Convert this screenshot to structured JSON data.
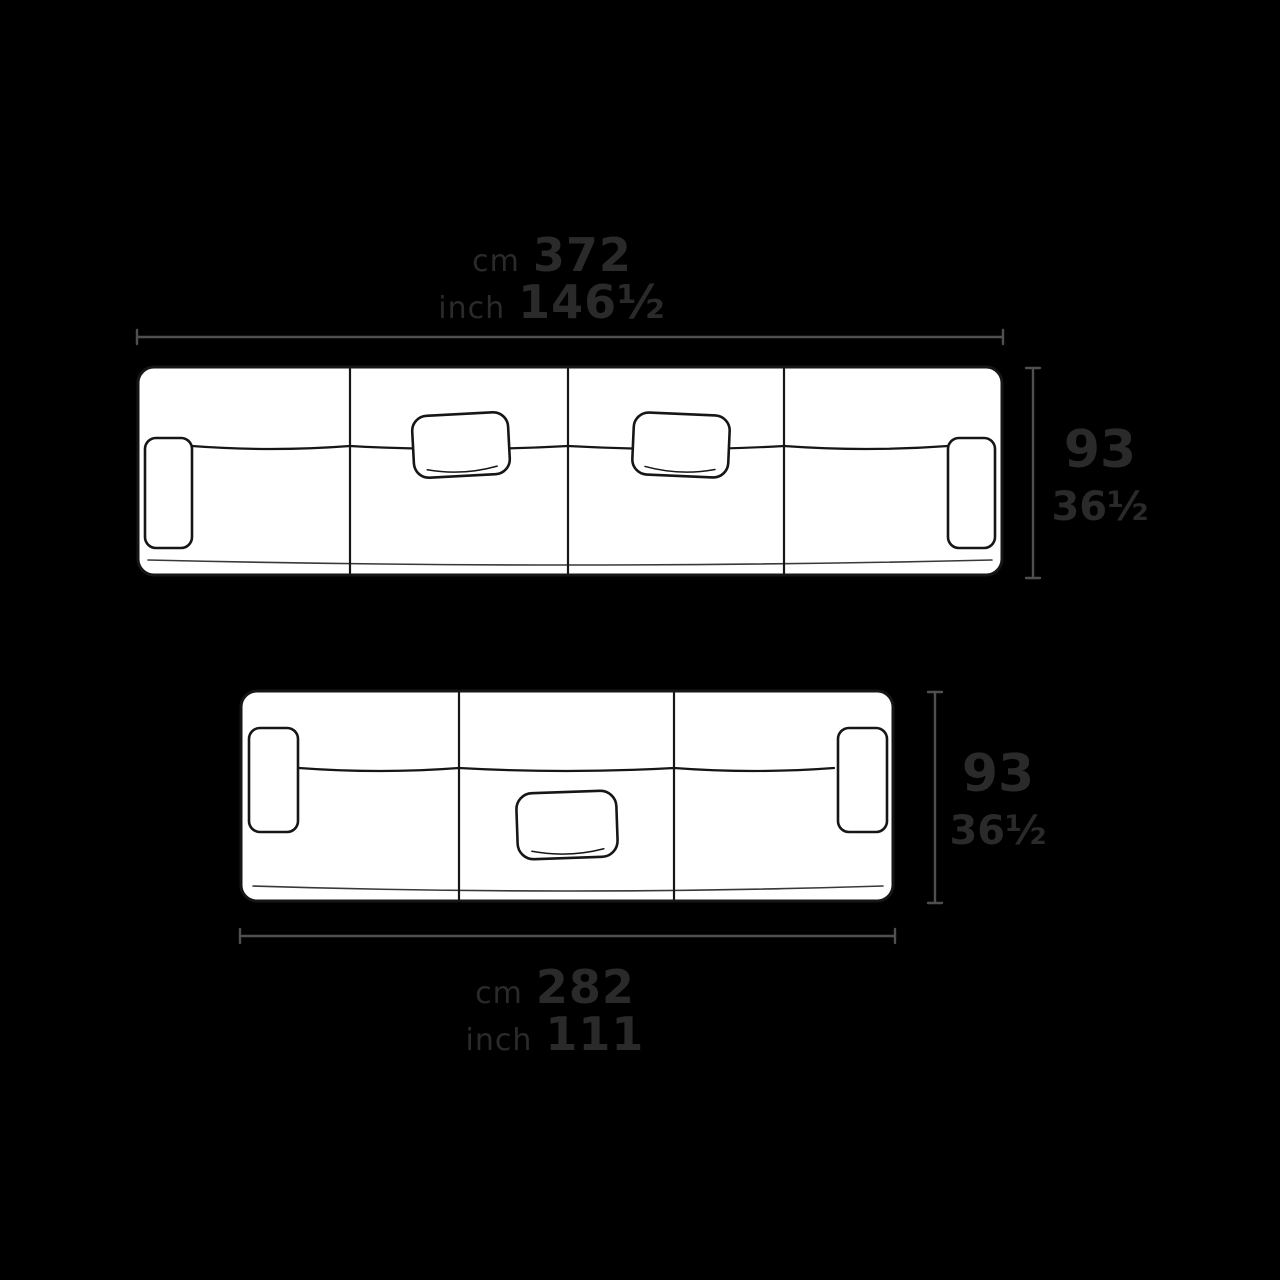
{
  "page": {
    "background": "#000000",
    "type": "sofa-dimension-diagram"
  },
  "colors": {
    "sofa_fill": "#ffffff",
    "sofa_outline": "#161616",
    "dimension_line": "#4f4f4f",
    "label_text": "#2a2a2a"
  },
  "sofa_large": {
    "description": "four-module sofa top view with two pillows and two armrests",
    "width_label": {
      "cm_unit": "cm",
      "cm_value": "372",
      "inch_unit": "inch",
      "inch_value": "146½"
    },
    "depth_label": {
      "cm_value": "93",
      "inch_value": "36½"
    }
  },
  "sofa_small": {
    "description": "three-module sofa top view with one pillow and two armrests",
    "width_label": {
      "cm_unit": "cm",
      "cm_value": "282",
      "inch_unit": "inch",
      "inch_value": "111"
    },
    "depth_label": {
      "cm_value": "93",
      "inch_value": "36½"
    }
  }
}
